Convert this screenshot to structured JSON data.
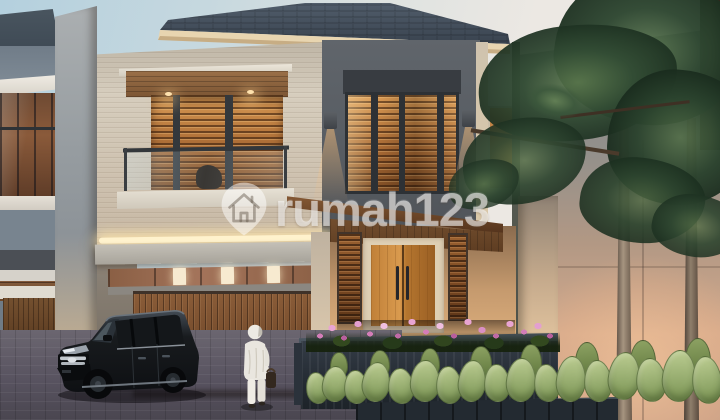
{
  "watermark": {
    "brand": "rumah123",
    "icon": "map-pin-house-icon"
  },
  "scene": {
    "type": "3d-exterior-render",
    "time_of_day": "dusk",
    "objects": [
      "two-storey modern tropical house",
      "dark hip roof",
      "balcony with glass railing",
      "warm-lit wood louvre windows",
      "wall sconces",
      "led cove lighting",
      "wood slat garage door",
      "wooden double entry door",
      "black mpv car",
      "person in white outfit walking",
      "pink flower planter",
      "cactus hedge",
      "pine tree with bare trunks",
      "neighbouring house",
      "stone boundary wall",
      "brick paver driveway"
    ]
  },
  "colors": {
    "sky_left": "#b4d0de",
    "sky_right": "#f0e9e2",
    "roof": "#44505d",
    "fascia": "#e8d5b0",
    "travertine_wall": "#d6cdbd",
    "dark_upper_wall": "#585d63",
    "wood": "#b97c3e",
    "warm_light": "#ffd9a0",
    "garage_door": "#7a5130",
    "driveway": "#5f5a63",
    "planter": "#262d36",
    "flowers": "#d37db8",
    "cactus": "#9cb171",
    "foliage": "#33493a",
    "watermark_white": "rgba(255,255,255,0.52)"
  }
}
